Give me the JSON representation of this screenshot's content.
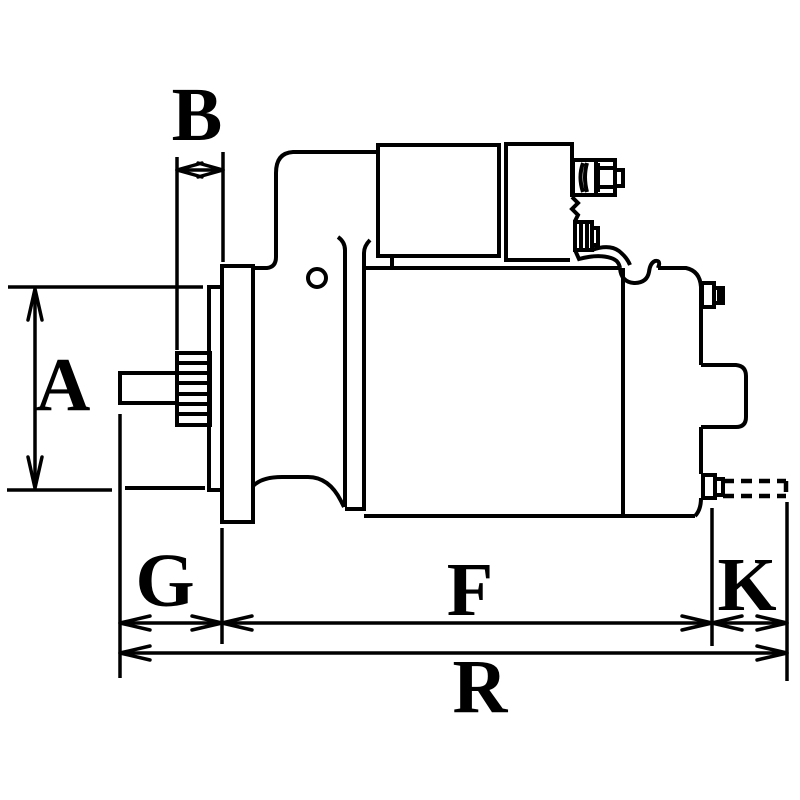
{
  "diagram": {
    "background_color": "#ffffff",
    "line_color": "#000000",
    "labels": {
      "A": "A",
      "B": "B",
      "G": "G",
      "F": "F",
      "K": "K",
      "R": "R"
    }
  }
}
